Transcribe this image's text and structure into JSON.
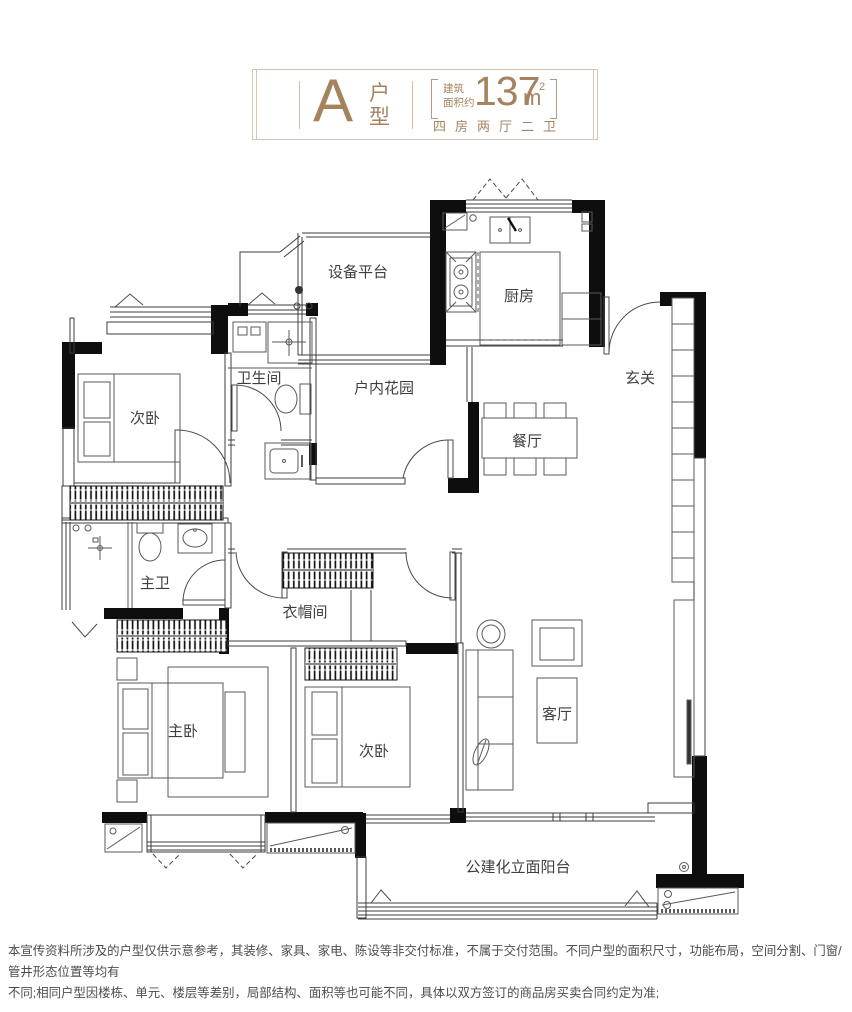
{
  "title_card": {
    "plan_letter": "A",
    "plan_type_label": "户型",
    "area_prefix_line1": "建筑",
    "area_prefix_line2": "面积约",
    "area_value": "137",
    "area_unit": "m",
    "area_sup": "2",
    "layout_summary": "四房两厅二卫"
  },
  "floor_plan": {
    "rooms": [
      {
        "id": "equipment-platform",
        "label": "设备平台"
      },
      {
        "id": "kitchen",
        "label": "厨房"
      },
      {
        "id": "foyer",
        "label": "玄关"
      },
      {
        "id": "bedroom-upper",
        "label": "次卧"
      },
      {
        "id": "bathroom",
        "label": "卫生间"
      },
      {
        "id": "indoor-garden",
        "label": "户内花园"
      },
      {
        "id": "dining-room",
        "label": "餐厅"
      },
      {
        "id": "master-bathroom",
        "label": "主卫"
      },
      {
        "id": "cloakroom",
        "label": "衣帽间"
      },
      {
        "id": "master-bedroom",
        "label": "主卧"
      },
      {
        "id": "bedroom-lower",
        "label": "次卧"
      },
      {
        "id": "living-room",
        "label": "客厅"
      },
      {
        "id": "balcony",
        "label": "公建化立面阳台"
      }
    ]
  },
  "disclaimer": {
    "line1": "本宣传资料所涉及的户型仅供示意参考，其装修、家具、家电、陈设等非交付标准，不属于交付范围。不同户型的面积尺寸，功能布局，空间分割、门窗/管井形态位置等均有",
    "line2": "不同;相同户型因楼栋、单元、楼层等差别，局部结构、面积等也可能不同，具体以双方签订的商品房买卖合同约定为准;"
  },
  "colors": {
    "accent": "#a5835f",
    "card_border": "#d4c5b2",
    "wall": "#0e0e0e",
    "label_text": "#3f3f3f",
    "disclaimer_text": "#4d4d4d"
  }
}
